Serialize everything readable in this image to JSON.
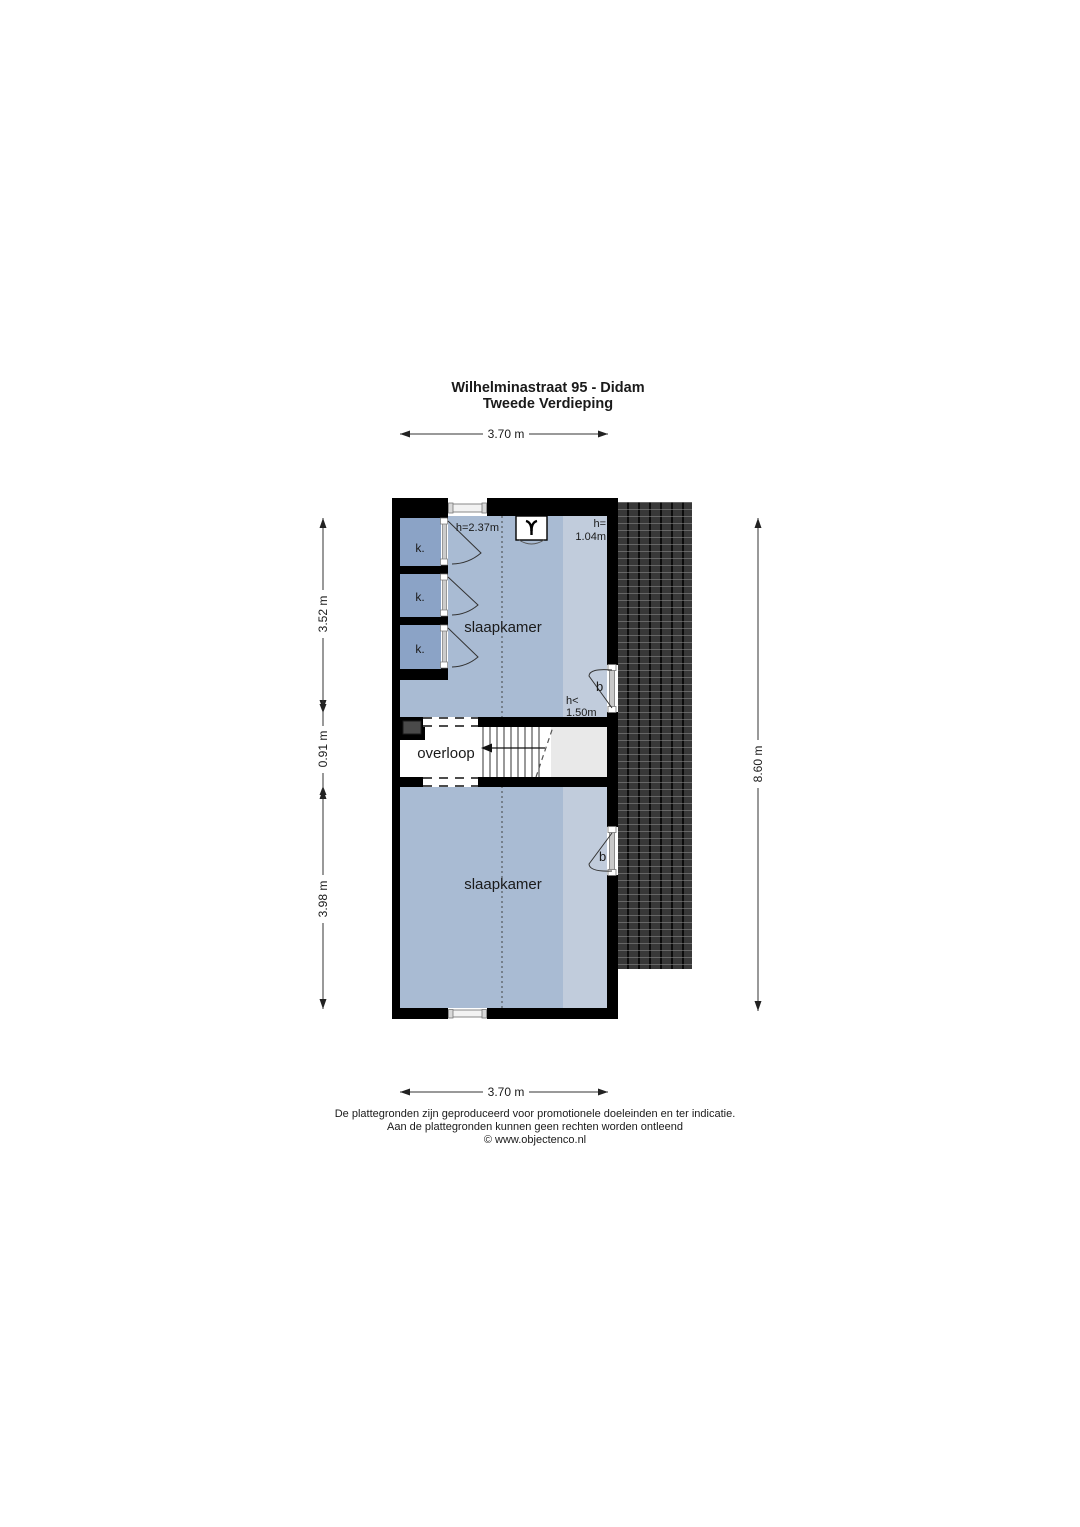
{
  "title": {
    "line1": "Wilhelminastraat 95 - Didam",
    "line2": "Tweede Verdieping"
  },
  "dimensions": {
    "top": "3.70 m",
    "bottom": "3.70 m",
    "left_top": "3.52 m",
    "left_middle": "0.91 m",
    "left_bottom": "3.98 m",
    "right": "8.60 m"
  },
  "rooms": {
    "bedroom_top": "slaapkamer",
    "bedroom_bottom": "slaapkamer",
    "landing": "overloop",
    "closet": "k."
  },
  "labels": {
    "ceiling_height": "h=2.37m",
    "knee_wall_prefix": "h=",
    "knee_wall_value": "1.04m",
    "low_height_prefix": "h<",
    "low_height_value": "1.50m",
    "door": "b"
  },
  "footer": {
    "line1": "De plattegronden zijn geproduceerd voor promotionele doeleinden en ter indicatie.",
    "line2": "Aan de plattegronden kunnen geen rechten worden ontleend",
    "line3": "© www.objectenco.nl"
  },
  "colors": {
    "room_fill": "#a9bbd3",
    "room_fill_low_zone": "#c1ccdc",
    "closet_fill": "#8ba3c6",
    "wall": "#000000",
    "roof": "#2c2c2c",
    "stair_zone": "#e9e9e9",
    "duct": "#4a4a4a"
  }
}
